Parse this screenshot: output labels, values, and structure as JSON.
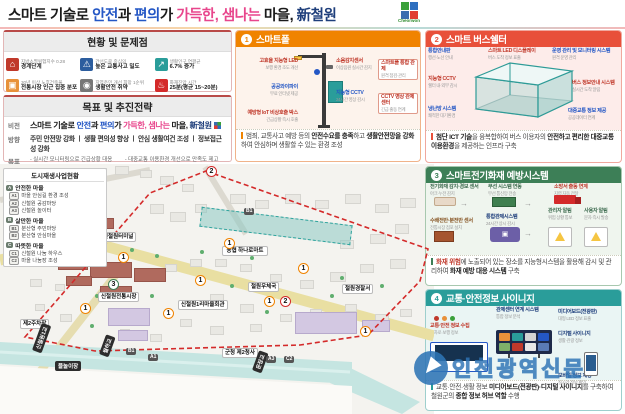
{
  "colors": {
    "accent_blue": "#2457c5",
    "accent_pink": "#e8468c",
    "navy": "#1e3e7b",
    "panel1_orange": "#f08300",
    "panel2_red": "#e8503a",
    "panel3_green": "#3d7f57",
    "panel4_teal": "#2a9d9a",
    "boundary_red": "#d42a2a"
  },
  "title": {
    "parts": [
      "스마트 기술로 ",
      "안전",
      "과 ",
      "편의",
      "가 ",
      "가득한,",
      " 샘나는",
      " 마을, ",
      "新철원"
    ],
    "logo_caption": "Cheorwon"
  },
  "status_panel": {
    "title": "현황 및 문제점",
    "items": [
      {
        "icon": "building-decline-icon",
        "caption": "지방소멸위험지수 0.28",
        "value": "경계단계"
      },
      {
        "icon": "traffic-accident-icon",
        "caption": "간선도로 중심의",
        "value": "높은 교통사고 밀도"
      },
      {
        "icon": "population-growth-icon",
        "caption": "생활인구 연평균",
        "value": "6.7% 증가"
      },
      {
        "icon": "old-buildings-icon",
        "caption": "30년 이상 노후건축물",
        "value": "전통시장 인근 집중 분포"
      },
      {
        "icon": "cctv-icon",
        "caption": "지역주민 개선 희망 1순위",
        "value": "생활안전 취약"
      },
      {
        "icon": "fire-truck-icon",
        "caption": "화재진압 시간",
        "value": "25분(평균 15~20분)"
      }
    ]
  },
  "goal_panel": {
    "title": "목표 및 추진전략",
    "vision_label": "비전",
    "direction_label": "방향",
    "direction": "주민 안전망 강화 ㅣ 생활 편의성 향상 ㅣ 안심 생활여건 조성 ㅣ 정보접근성 강화",
    "goal_label": "목표",
    "goals_left": [
      "-  실시간 모니터링으로 긴급상황 대응",
      "-  주민 및 방문객이 안전한 생활환경 조성"
    ],
    "goals_right": [
      "-  대중교통 이용환경 개선으로 만족도 제고",
      "-  실시간 교통·안전·생활 등의 정보 접근성 개선"
    ]
  },
  "legend": {
    "title": "도시재생사업현황",
    "groups": [
      {
        "badge": "A",
        "name": "안전한 마을",
        "items": [
          {
            "badge": "A1",
            "text": "마을 안심길 환경 조성"
          },
          {
            "badge": "A2",
            "text": "신철원 공감마당"
          },
          {
            "badge": "A3",
            "text": "신철원 놀이터"
          }
        ]
      },
      {
        "badge": "B",
        "name": "살만한 마을",
        "items": [
          {
            "badge": "B1",
            "text": "분산형 주민마당"
          },
          {
            "badge": "B2",
            "text": "분산형 안심마을"
          }
        ]
      },
      {
        "badge": "C",
        "name": "따뜻한 마을",
        "items": [
          {
            "badge": "C1",
            "text": "신철원 나눔 하우스"
          },
          {
            "badge": "C2",
            "text": "마을 나눔장 조성"
          }
        ]
      }
    ]
  },
  "map": {
    "pois": [
      {
        "text": "신철원터미널"
      },
      {
        "text": "농협 하나로마트"
      },
      {
        "text": "철원우체국"
      },
      {
        "text": "철원경찰서"
      },
      {
        "text": "신철원전통시장"
      },
      {
        "text": "신철원1리마을회관"
      },
      {
        "text": "군청 제2청사"
      },
      {
        "text": "제2주차장"
      }
    ],
    "tags": [
      {
        "text": "신철원1교"
      },
      {
        "text": "물놀이장"
      },
      {
        "text": "월하교"
      },
      {
        "text": "운장교"
      }
    ],
    "badges": [
      "2",
      "4",
      "1",
      "1",
      "1",
      "3",
      "1",
      "1",
      "2",
      "1",
      "1",
      "1"
    ],
    "area_badges": [
      "B1",
      "C1",
      "B1",
      "A1",
      "A3",
      "C2"
    ]
  },
  "panel1": {
    "number": "1",
    "title": "스마트폴",
    "callouts_left": [
      {
        "h": "고효율 지능형 LED",
        "s": "보행 환경 조도 개선"
      },
      {
        "h": "공공와이파이",
        "s": "무료 인터넷 제공"
      },
      {
        "h": "예방형 IoT 비상호출 박스",
        "s": "긴급상황 즉시 호출"
      }
    ],
    "callouts_right": [
      {
        "h": "소음감지센서",
        "s": "이상음원 실시간 감지"
      },
      {
        "h": "지능형 CCTV",
        "s": "24시간 영상 감시"
      }
    ],
    "boxes": [
      {
        "h": "스마트폴 통합 관제",
        "s": "원격 점검·관리"
      },
      {
        "h": "CCTV 영상 관제 센터",
        "s": "긴급 출동 연계"
      }
    ],
    "desc": [
      {
        "t": "범죄, 교통사고 예방 등의 "
      },
      {
        "t": "안전수요를 충족"
      },
      {
        "t": "하고 "
      },
      {
        "t": "생활안전망을 강화"
      },
      {
        "t": "하여 안심하며 생활할 수 있는 환경 조성"
      }
    ]
  },
  "panel2": {
    "number": "2",
    "title": "스마트 버스쉘터",
    "callouts": [
      {
        "h": "통합안내판",
        "s": "행선·노선 안내"
      },
      {
        "h": "지능형 CCTV",
        "s": "쉘터 내·외부 감시"
      },
      {
        "h": "냉난방 시스템",
        "s": "쾌적한 대기환경"
      },
      {
        "h": "스마트 LED 디스플레이",
        "s": "버스 도착 정보 표출"
      },
      {
        "h": "운영 관리 및 모니터링 시스템",
        "s": "원격 운영 관리"
      },
      {
        "h": "버스 정보안내 시스템",
        "s": "실시간 도착 알림"
      },
      {
        "h": "대중교통 정보 제공",
        "s": "공공데이터 연계"
      }
    ],
    "desc": [
      {
        "t": "첨단 ICT 기술"
      },
      {
        "t": "을 융복합하여 버스 이용자의 "
      },
      {
        "t": "안전하고 편리한"
      },
      {
        "t": " "
      },
      {
        "t": "대중교통 이용환경"
      },
      {
        "t": "을 제공하는 인프라 구축"
      }
    ]
  },
  "panel3": {
    "number": "3",
    "title": "스마트전기화재 예방시스템",
    "callouts": [
      {
        "h": "전기화재 감지·경보 센서",
        "s": "아크·누전 감지"
      },
      {
        "h": "수배전반·분전반 센서",
        "s": "전통시장 점포 설치"
      },
      {
        "h": "무선 시스템 연동",
        "s": "무선 통신망 전송"
      },
      {
        "h": "통합관제시스템",
        "s": "24시간 상시 감시"
      },
      {
        "h": "소방서 출동 연계",
        "s": "지령 자동 전달"
      },
      {
        "h": "관리자 알림",
        "s": "위험 상황 통보"
      },
      {
        "h": "사용자 알림",
        "s": "문자 즉시 발송"
      }
    ],
    "desc": [
      {
        "t": "화재 위험"
      },
      {
        "t": "에 노출되어 있는 장소를 지능형시스템을 활용해 감시 및 관리하여 "
      },
      {
        "t": "화재 예방 대응 시스템"
      },
      {
        "t": " 구축"
      }
    ]
  },
  "panel4": {
    "number": "4",
    "title": "교통·안전정보 사이니지",
    "callouts": [
      {
        "h": "교통·안전 정보 수집",
        "s": "교차로·보행 정보"
      },
      {
        "h": "관제센터 연계 시스템",
        "s": "통합 정보 분석"
      },
      {
        "h": "미디어보드(전광판)",
        "s": "대형 LED 정보 표출"
      },
      {
        "h": "디지털 사이니지",
        "s": "생활·관광 정보"
      },
      {
        "h": "모바일 정보 제공",
        "s": "실시간 정보 확인"
      }
    ],
    "desc": [
      {
        "t": "교통·안전·생활 정보 "
      },
      {
        "t": "미디어보드(전광판)·디지털 사이니지"
      },
      {
        "t": "를 구축하여 철원군의 "
      },
      {
        "t": "종합 정보 허브 역할"
      },
      {
        "t": " 수행"
      }
    ]
  },
  "watermark": {
    "text": "인천광역신문"
  }
}
